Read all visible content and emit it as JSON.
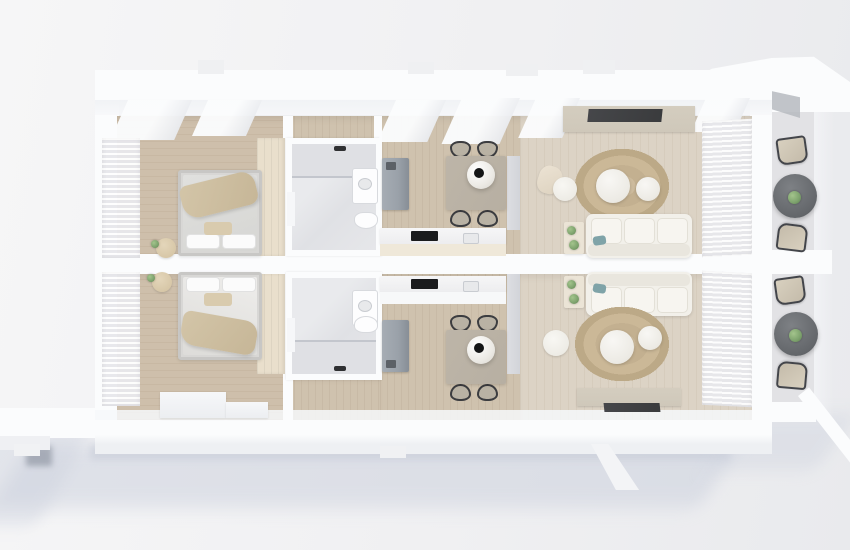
{
  "scene": {
    "kind": "3d-floor-plan-top-view-render",
    "units": [
      {
        "name": "apartment-top",
        "rooms": [
          "bedroom",
          "bathroom",
          "kitchen-dining",
          "living-room",
          "balcony"
        ]
      },
      {
        "name": "apartment-bottom",
        "rooms": [
          "bedroom",
          "bathroom",
          "kitchen-dining",
          "living-room",
          "balcony"
        ]
      }
    ],
    "furniture": {
      "bedroom": [
        "double-bed",
        "pillows",
        "throw-blanket",
        "wardrobe",
        "curtains",
        "pouf",
        "plant"
      ],
      "bathroom": [
        "shower",
        "glass-partition",
        "toilet",
        "vanity-sink",
        "door"
      ],
      "kitchen-dining": [
        "kitchen-counter",
        "cooktop",
        "sink",
        "tall-fridge-unit",
        "dining-table",
        "four-chairs",
        "pendant-lamp"
      ],
      "living-room": [
        "three-seat-sofa",
        "teal-cushion",
        "side-table-with-plants",
        "round-jute-rug",
        "two-round-coffee-tables",
        "pouf",
        "tv-console",
        "tv",
        "curtains"
      ],
      "balcony": [
        "two-lounge-chairs",
        "round-stone-table",
        "plant"
      ]
    }
  },
  "palette": {
    "bg_top": "#f6f6f7",
    "bg_right": "#e9eaed",
    "shadow": "#cdd2de",
    "wall_white": "#fbfcfd",
    "wall_shade": "#eceef1",
    "wood_bedroom": "#cebfab",
    "wood_kitchen": "#cfc2ae",
    "wood_living": "#dcd3c5",
    "balcony_floor": "#e2e2e5",
    "rug": "#c3b090",
    "sofa": "#f2f0ea",
    "teal": "#7fa3a8",
    "fridge_gray": "#9aa1a9",
    "table_wood": "#b7afa2",
    "chair_dark": "#3c3d40",
    "chair_seat": "#b9b2a4",
    "balcony_table": "#64676b",
    "plant_green": "#7da26d",
    "console_beige": "#cfc8ba",
    "tv_dark": "#3a3b3d",
    "wardrobe": "#e9dfcc",
    "counter_beige": "#efe8d9",
    "cooktop": "#1a1b1d",
    "pendant_dot": "#141516"
  }
}
